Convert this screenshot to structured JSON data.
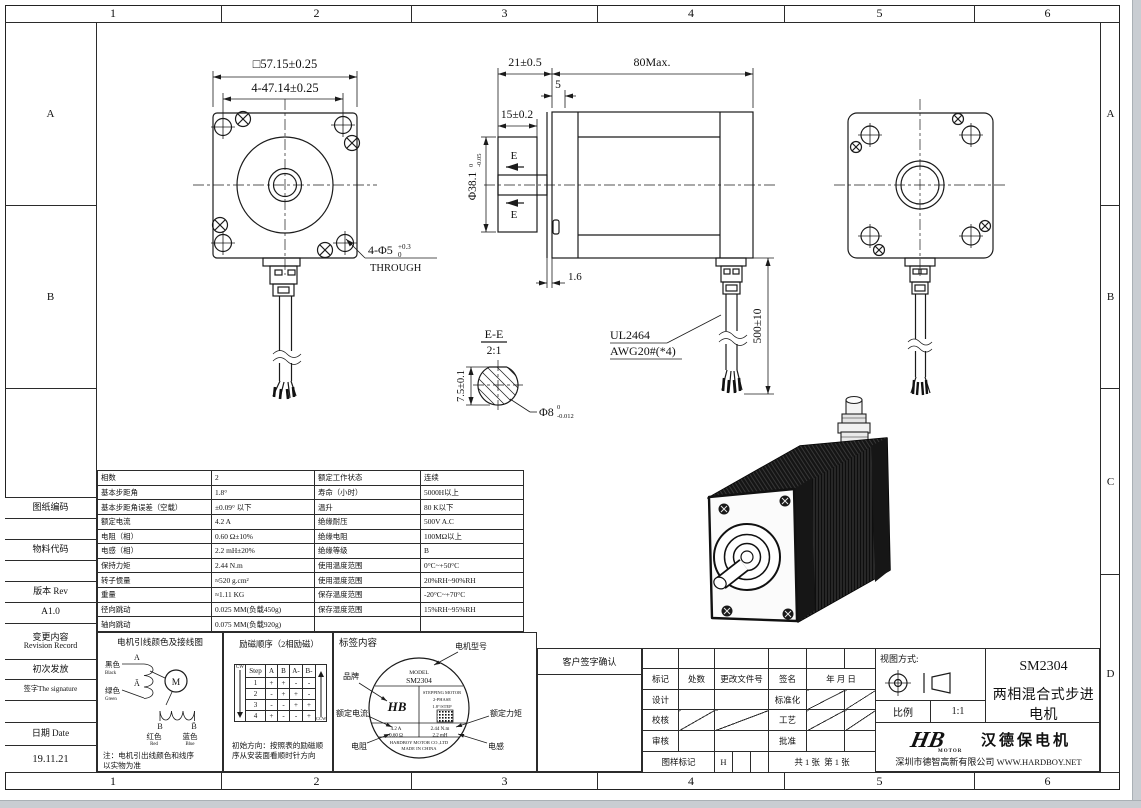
{
  "frame": {
    "cols": [
      "1",
      "2",
      "3",
      "4",
      "5",
      "6"
    ],
    "rows": [
      "A",
      "B",
      "C",
      "D"
    ]
  },
  "left_panel": {
    "drawing_no": "图纸编码",
    "material_no": "物料代码",
    "rev_label": "版本 Rev",
    "rev": "A1.0",
    "change_cn": "变更内容",
    "change_en": "Revision Record",
    "first_issue": "初次发放",
    "sign_label": "签字The signature",
    "date_label": "日期 Date",
    "date": "19.11.21"
  },
  "front_view": {
    "dim_square": "□57.15±0.25",
    "dim_pitch": "4-47.14±0.25",
    "holes_label": "4-Φ5",
    "holes_tol_sup": "+0.3",
    "holes_tol_sub": "0",
    "holes_through": "THROUGH"
  },
  "side_view": {
    "dim_front": "21±0.5",
    "dim_body": "80Max.",
    "dim_step": "5",
    "dim_shaft": "15±0.2",
    "pilot": "Φ38.1",
    "pilot_sup": "0",
    "pilot_sub": "-0.05",
    "front_step": "1.6",
    "section_mark": "E",
    "cable1": "UL2464",
    "cable2": "AWG20#(*4)",
    "cable_len": "500±10"
  },
  "section_view": {
    "title": "E-E",
    "scale": "2:1",
    "dim_flat": "7.5±0.1",
    "dia": "Φ8",
    "dia_sup": "0",
    "dia_sub": "-0.012"
  },
  "spec_table": {
    "rows": [
      {
        "l1": "相数",
        "v1": "2",
        "l2": "额定工作状态",
        "v2": "连续"
      },
      {
        "l1": "基本步距角",
        "v1": "1.8°",
        "l2": "寿命（小时）",
        "v2": "5000H以上"
      },
      {
        "l1": "基本步距角误差（空载）",
        "v1": "±0.09° 以下",
        "l2": "温升",
        "v2": "80 K以下"
      },
      {
        "l1": "额定电流",
        "v1": "4.2 A",
        "l2": "绝缘耐压",
        "v2": "500V A.C"
      },
      {
        "l1": "电阻（相）",
        "v1": "0.60 Ω±10%",
        "l2": "绝缘电阻",
        "v2": "100MΩ以上"
      },
      {
        "l1": "电感（相）",
        "v1": "2.2 mH±20%",
        "l2": "绝缘等级",
        "v2": "B"
      },
      {
        "l1": "保持力矩",
        "v1": "2.44 N.m",
        "l2": "使用温度范围",
        "v2": "0°C~+50°C"
      },
      {
        "l1": "转子惯量",
        "v1": "≈520 g.cm²",
        "l2": "使用湿度范围",
        "v2": "20%RH~90%RH"
      },
      {
        "l1": "重量",
        "v1": "≈1.11 KG",
        "l2": "保存温度范围",
        "v2": "-20°C~+70°C"
      },
      {
        "l1": "径向跳动",
        "v1": "0.025 MM(负载450g)",
        "l2": "保存湿度范围",
        "v2": "15%RH~95%RH"
      },
      {
        "l1": "轴向跳动",
        "v1": "0.075 MM(负载920g)",
        "l2": "",
        "v2": ""
      }
    ]
  },
  "wiring": {
    "title": "电机引线颜色及接线图",
    "black_cn": "黑色",
    "black_en": "Black",
    "a": "A",
    "a_bar": "Ā",
    "green_cn": "绿色",
    "green_en": "Green",
    "motor": "M",
    "b": "B",
    "b_bar": "B̄",
    "red_cn": "红色",
    "red_en": "Red",
    "blue_cn": "蓝色",
    "blue_en": "Blue",
    "note1": "注：电机引出线颜色和线序",
    "note2": "以实物为准"
  },
  "excitation": {
    "title": "励磁顺序（2相励磁）",
    "cw": "CW",
    "ccw": "CCW",
    "headers": [
      "Step",
      "A",
      "B",
      "A-",
      "B-"
    ],
    "rows": [
      [
        "1",
        "+",
        "+",
        "-",
        "-"
      ],
      [
        "2",
        "-",
        "+",
        "+",
        "-"
      ],
      [
        "3",
        "-",
        "-",
        "+",
        "+"
      ],
      [
        "4",
        "+",
        "-",
        "-",
        "+"
      ]
    ],
    "note1": "初始方向：按照表的励磁顺",
    "note2": "序从安装面看顺时针方向"
  },
  "label_section": {
    "title": "标签内容",
    "callout_model": "电机型号",
    "callout_brand": "品牌",
    "callout_current": "额定电流",
    "callout_torque": "额定力矩",
    "callout_res": "电阻",
    "callout_ind": "电感",
    "model_word": "MODEL",
    "model": "SM2304",
    "logo": "HB",
    "type1": "STEPPING MOTOR",
    "type2": "2-PHASE",
    "type3": "1.8°/STEP",
    "v_current": "4.2 A",
    "v_torque": "2.44 N.m",
    "v_res": "0.60 Ω",
    "v_ind": "2.2 mH",
    "company": "HARDBOY MOTOR CO.,LTD",
    "origin": "MADE IN CHINA"
  },
  "customer": {
    "confirm": "客户签字确认"
  },
  "signature": {
    "mark": "标记",
    "qty": "处数",
    "doc_no": "更改文件号",
    "sign": "签名",
    "date": "年 月 日",
    "design": "设计",
    "standard": "标准化",
    "check": "校核",
    "craft": "工艺",
    "review": "审核",
    "approve": "批准",
    "sample_mark": "图样标记",
    "sample_value": "H",
    "total_sheets": "共 1 张",
    "sheet_no": "第 1 张"
  },
  "title_block": {
    "view_method": "视图方式:",
    "scale_label": "比例",
    "scale_value": "1:1",
    "model": "SM2304",
    "product": "两相混合式步进电机",
    "logo_text": "HB",
    "logo_sub": "MOTOR",
    "brand": "汉德保电机",
    "company": "深圳市德智高新有限公司",
    "website": "WWW.HARDBOY.NET"
  }
}
